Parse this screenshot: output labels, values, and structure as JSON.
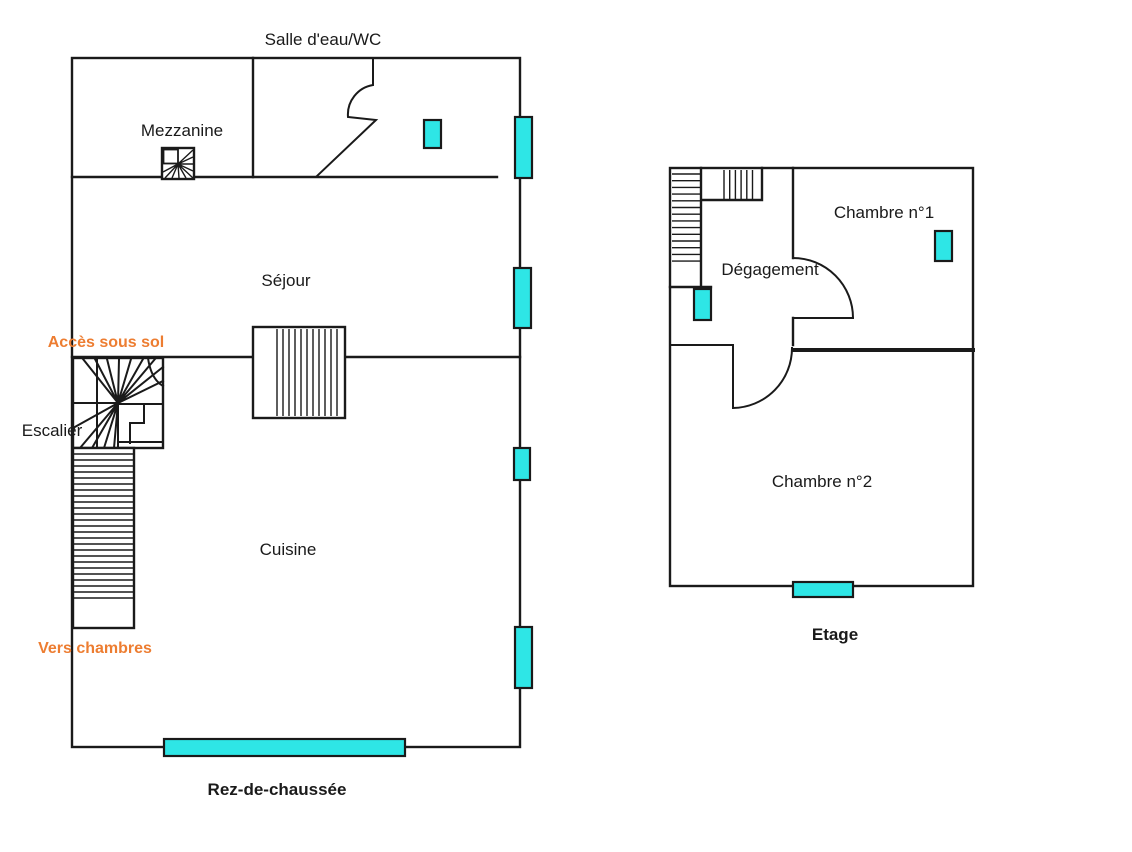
{
  "colors": {
    "wall": "#1a1a1a",
    "window-fill": "#2ee6e6",
    "label-orange": "#ed7d31",
    "background": "#ffffff",
    "text": "#1a1a1a"
  },
  "ground_floor": {
    "title": "Rez-de-chaussée",
    "rooms": {
      "salle_eau_wc": "Salle d'eau/WC",
      "mezzanine": "Mezzanine",
      "sejour": "Séjour",
      "cuisine": "Cuisine"
    },
    "annotations": {
      "escalier": "Escalier",
      "acces_sous_sol": "Accès sous sol",
      "vers_chambres": "Vers chambres"
    }
  },
  "upper_floor": {
    "title": "Etage",
    "rooms": {
      "chambre_1": "Chambre n°1",
      "degagement": "Dégagement",
      "chambre_2": "Chambre n°2"
    }
  }
}
